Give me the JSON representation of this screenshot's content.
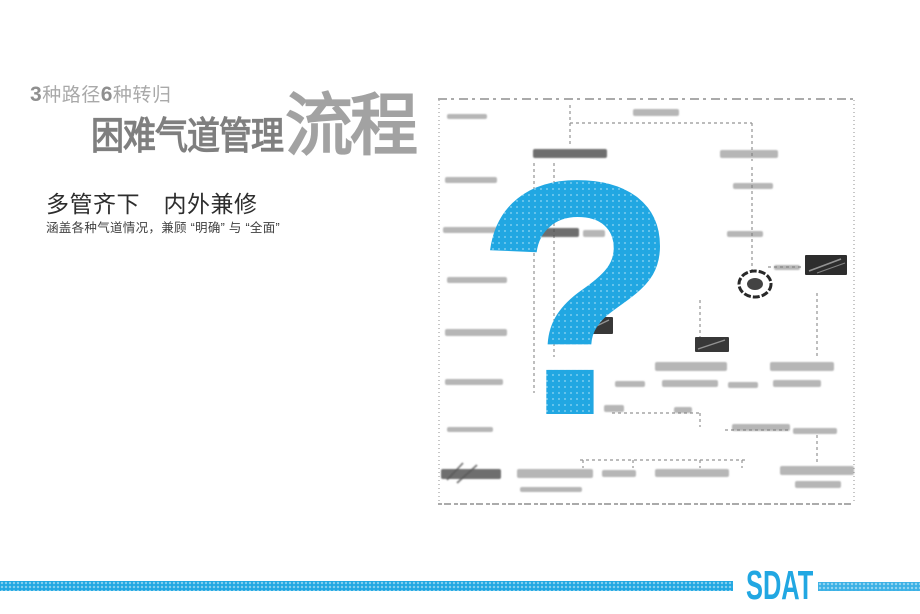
{
  "slide": {
    "kicker": {
      "num1": "3",
      "text1": "种路径",
      "num2": "6",
      "text2": "种转归"
    },
    "title": {
      "main": "困难气道管理",
      "accent": "流程"
    },
    "subtitle": "多管齐下　内外兼修",
    "description": "涵盖各种气道情况，兼顾 “明确” 与 “全面”",
    "figure": {
      "overlay_glyph": "?"
    },
    "footer": {
      "brand": "SDAT"
    },
    "colors": {
      "accent": "#21A7E2",
      "kicker": "#a9a9a9",
      "kicker_num": "#8f8f8f",
      "title_main": "#7f7f7f",
      "title_accent": "#a2a2a2",
      "subtitle": "#2d2d2d",
      "description": "#3f3f3f"
    }
  }
}
